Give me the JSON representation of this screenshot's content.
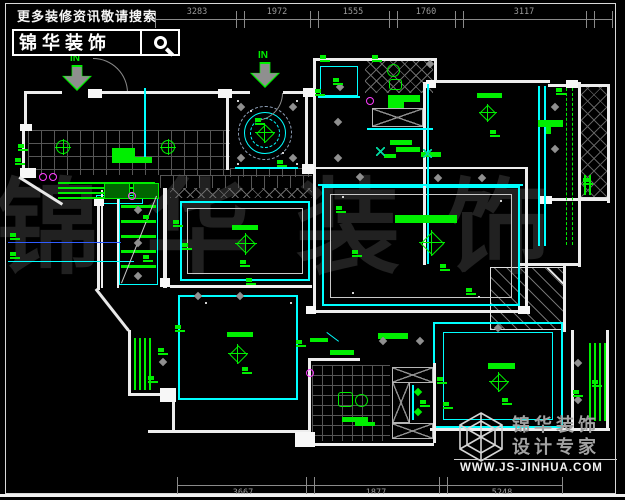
{
  "search_box": {
    "tagline": "更多装修资讯敬请搜索",
    "brand": "锦华装饰",
    "icon": "magnifier-icon"
  },
  "watermark": {
    "text": "锦华装饰"
  },
  "logo": {
    "line1": "锦华装饰",
    "line2": "设计专家",
    "website": "WWW.JS-JINHUA.COM",
    "icon": "cube-logo-icon"
  },
  "entry_markers": [
    {
      "label": "IN",
      "x": 62,
      "y": 53
    },
    {
      "label": "IN",
      "x": 250,
      "y": 50
    }
  ],
  "colors": {
    "annotation_green": "#00ef00",
    "ceiling_cyan": "#00ffff",
    "wall_white": "#ededed",
    "dim_gray": "#9a9a9a",
    "magenta": "#ff3cff",
    "leader_blue": "#2f5cff",
    "watermark_gray": "#212121"
  },
  "dimensions": {
    "top": {
      "line_y": 19,
      "x_start": 155,
      "x_end": 612,
      "boundaries": [
        155,
        240,
        314,
        393,
        459,
        590,
        612
      ],
      "labels": [
        {
          "t": "3283",
          "c": 197
        },
        {
          "t": "1972",
          "c": 277
        },
        {
          "t": "1555",
          "c": 353
        },
        {
          "t": "1760",
          "c": 426
        },
        {
          "t": "3117",
          "c": 524
        }
      ]
    },
    "bottom": {
      "line_y": 485,
      "x_start": 177,
      "x_end": 562,
      "boundaries": [
        177,
        310,
        443,
        562
      ],
      "labels": [
        {
          "t": "3667",
          "c": 243
        },
        {
          "t": "1877",
          "c": 376
        },
        {
          "t": "5248",
          "c": 502
        }
      ]
    }
  },
  "plan": {
    "walls": [
      [
        26,
        91,
        36,
        3
      ],
      [
        96,
        91,
        154,
        3
      ],
      [
        283,
        91,
        31,
        3
      ],
      [
        24,
        91,
        3,
        39
      ],
      [
        22,
        128,
        3,
        50
      ],
      [
        313,
        58,
        3,
        133
      ],
      [
        314,
        58,
        122,
        3
      ],
      [
        434,
        58,
        3,
        25
      ],
      [
        434,
        80,
        116,
        3
      ],
      [
        548,
        84,
        62,
        3
      ],
      [
        607,
        84,
        3,
        117
      ],
      [
        578,
        82,
        3,
        185
      ],
      [
        548,
        198,
        60,
        3
      ],
      [
        520,
        263,
        60,
        3
      ],
      [
        563,
        265,
        3,
        67
      ],
      [
        226,
        93,
        3,
        77
      ],
      [
        305,
        93,
        3,
        77
      ],
      [
        316,
        167,
        210,
        2
      ],
      [
        525,
        167,
        3,
        146
      ],
      [
        313,
        188,
        3,
        125
      ],
      [
        313,
        310,
        215,
        3
      ],
      [
        163,
        188,
        4,
        100
      ],
      [
        170,
        285,
        142,
        3
      ],
      [
        101,
        190,
        2,
        98
      ],
      [
        117,
        190,
        2,
        98
      ],
      [
        97,
        203,
        3,
        87
      ],
      [
        128,
        330,
        3,
        65
      ],
      [
        128,
        393,
        47,
        3
      ],
      [
        172,
        395,
        3,
        37
      ],
      [
        148,
        430,
        162,
        3
      ],
      [
        308,
        358,
        52,
        3
      ],
      [
        308,
        358,
        3,
        88
      ],
      [
        310,
        443,
        124,
        3
      ],
      [
        433,
        363,
        3,
        80
      ],
      [
        430,
        428,
        180,
        3
      ],
      [
        423,
        82,
        3,
        183
      ],
      [
        571,
        330,
        3,
        100
      ],
      [
        606,
        330,
        3,
        100
      ],
      [
        607,
        195,
        3,
        8
      ]
    ],
    "blocks": [
      [
        88,
        89,
        14,
        9
      ],
      [
        218,
        89,
        14,
        9
      ],
      [
        303,
        88,
        12,
        9
      ],
      [
        302,
        164,
        12,
        10
      ],
      [
        20,
        168,
        16,
        10
      ],
      [
        94,
        198,
        10,
        8
      ],
      [
        566,
        80,
        12,
        8
      ],
      [
        540,
        196,
        12,
        8
      ],
      [
        160,
        388,
        16,
        14
      ],
      [
        295,
        432,
        20,
        15
      ],
      [
        20,
        124,
        12,
        7
      ],
      [
        518,
        306,
        12,
        8
      ],
      [
        306,
        306,
        10,
        8
      ],
      [
        426,
        80,
        10,
        8
      ],
      [
        160,
        278,
        10,
        9
      ]
    ],
    "cyan_rects": [
      [
        320,
        66,
        38,
        30,
        1.5
      ],
      [
        322,
        186,
        198,
        120,
        2
      ],
      [
        180,
        201,
        130,
        80,
        2
      ],
      [
        178,
        295,
        120,
        105,
        2.5
      ],
      [
        433,
        322,
        130,
        106,
        2
      ],
      [
        443,
        332,
        110,
        88,
        1.5
      ],
      [
        119,
        193,
        39,
        92,
        1.5
      ],
      [
        96,
        195,
        47,
        9,
        1
      ]
    ],
    "white_rects": [
      [
        330,
        194,
        182,
        104
      ],
      [
        187,
        208,
        116,
        66
      ]
    ],
    "xboxes": [
      [
        372,
        108,
        51,
        19
      ],
      [
        392,
        367,
        41,
        16
      ],
      [
        392,
        423,
        41,
        16
      ],
      [
        392,
        382,
        18,
        41
      ]
    ],
    "hatch_cross": [
      [
        170,
        188,
        142,
        10
      ],
      [
        365,
        60,
        68,
        33
      ]
    ],
    "hatch_cross_bordered": [
      [
        580,
        86,
        28,
        112
      ]
    ],
    "hatch_diag": [
      [
        490,
        267,
        74,
        63
      ]
    ],
    "grids": [
      [
        28,
        130,
        202,
        45,
        13
      ],
      [
        160,
        175,
        152,
        13,
        13
      ],
      [
        230,
        168,
        82,
        9,
        13
      ],
      [
        312,
        365,
        78,
        76,
        10
      ]
    ],
    "cyan_lines": [
      [
        235,
        167,
        63,
        2
      ],
      [
        318,
        184,
        205,
        2
      ],
      [
        538,
        86,
        2,
        160
      ],
      [
        544,
        86,
        2,
        160
      ],
      [
        144,
        88,
        2,
        72
      ],
      [
        412,
        385,
        2,
        35
      ],
      [
        427,
        84,
        2,
        180
      ],
      [
        367,
        128,
        66,
        2
      ],
      [
        318,
        96,
        42,
        2
      ],
      [
        8,
        261,
        126,
        1
      ]
    ],
    "blue_lines": [
      [
        8,
        242,
        113,
        1
      ]
    ],
    "green_vlines": [
      [
        134,
        338,
        52
      ],
      [
        139,
        338,
        52
      ],
      [
        144,
        338,
        52
      ],
      [
        149,
        338,
        52
      ],
      [
        589,
        343,
        78
      ],
      [
        594,
        343,
        78
      ],
      [
        599,
        343,
        78
      ],
      [
        604,
        343,
        78
      ],
      [
        584,
        175,
        20
      ],
      [
        589,
        175,
        20
      ]
    ],
    "green_hlines": [
      [
        58,
        182,
        97
      ],
      [
        58,
        187,
        97
      ],
      [
        58,
        192,
        97
      ],
      [
        58,
        197,
        97
      ]
    ],
    "stair_steps": [
      [
        121,
        205,
        35
      ],
      [
        121,
        220,
        35
      ],
      [
        121,
        235,
        35
      ],
      [
        121,
        250,
        35
      ],
      [
        121,
        265,
        35
      ]
    ],
    "green_boxes": [
      [
        104,
        183,
        26,
        16
      ],
      [
        133,
        183,
        26,
        16
      ]
    ],
    "dashed_cols": [
      [
        566,
        88,
        157
      ],
      [
        572,
        88,
        157
      ]
    ],
    "bars": [
      [
        232,
        225,
        26,
        5
      ],
      [
        395,
        215,
        62,
        8
      ],
      [
        477,
        93,
        25,
        5
      ],
      [
        227,
        332,
        26,
        5
      ],
      [
        488,
        363,
        27,
        6
      ],
      [
        112,
        148,
        23,
        9
      ],
      [
        112,
        157,
        40,
        6
      ],
      [
        388,
        95,
        32,
        7
      ],
      [
        388,
        102,
        16,
        6
      ],
      [
        390,
        140,
        22,
        5
      ],
      [
        396,
        147,
        24,
        5
      ],
      [
        384,
        154,
        12,
        4
      ],
      [
        421,
        152,
        20,
        5
      ],
      [
        330,
        350,
        24,
        5
      ],
      [
        378,
        333,
        30,
        6
      ],
      [
        310,
        338,
        18,
        4
      ],
      [
        342,
        417,
        26,
        5
      ],
      [
        355,
        422,
        20,
        4
      ],
      [
        538,
        120,
        25,
        7
      ],
      [
        546,
        127,
        5,
        7
      ]
    ],
    "tags": [
      [
        18,
        144
      ],
      [
        15,
        158
      ],
      [
        10,
        233
      ],
      [
        10,
        252
      ],
      [
        173,
        220
      ],
      [
        182,
        243
      ],
      [
        240,
        260
      ],
      [
        246,
        278
      ],
      [
        255,
        118
      ],
      [
        277,
        160
      ],
      [
        333,
        78
      ],
      [
        315,
        89
      ],
      [
        352,
        250
      ],
      [
        440,
        264
      ],
      [
        336,
        206
      ],
      [
        466,
        288
      ],
      [
        490,
        130
      ],
      [
        175,
        325
      ],
      [
        158,
        348
      ],
      [
        148,
        376
      ],
      [
        242,
        367
      ],
      [
        296,
        340
      ],
      [
        437,
        377
      ],
      [
        443,
        402
      ],
      [
        420,
        400
      ],
      [
        502,
        398
      ],
      [
        592,
        380
      ],
      [
        573,
        390
      ],
      [
        320,
        55
      ],
      [
        372,
        55
      ],
      [
        143,
        215
      ],
      [
        143,
        255
      ],
      [
        583,
        178
      ],
      [
        556,
        88
      ]
    ],
    "diamonds": [
      [
        241,
        107
      ],
      [
        293,
        107
      ],
      [
        241,
        158
      ],
      [
        293,
        158
      ],
      [
        340,
        87
      ],
      [
        338,
        122
      ],
      [
        338,
        158
      ],
      [
        360,
        177
      ],
      [
        438,
        178
      ],
      [
        482,
        178
      ],
      [
        198,
        296
      ],
      [
        240,
        296
      ],
      [
        138,
        210
      ],
      [
        138,
        243
      ],
      [
        138,
        276
      ],
      [
        555,
        107
      ],
      [
        555,
        149
      ],
      [
        578,
        363
      ],
      [
        578,
        400
      ],
      [
        498,
        328
      ],
      [
        163,
        362
      ],
      [
        383,
        341
      ],
      [
        420,
        341
      ],
      [
        430,
        64
      ]
    ],
    "diamonds_green": [
      [
        418,
        392
      ],
      [
        418,
        412
      ]
    ],
    "magenta": [
      [
        43,
        177
      ],
      [
        53,
        177
      ],
      [
        310,
        373
      ],
      [
        370,
        101
      ],
      [
        132,
        196
      ]
    ],
    "green_x": [
      [
        376,
        147
      ],
      [
        423,
        149
      ]
    ],
    "lamps": [
      [
        265,
        133,
        20
      ],
      [
        246,
        244,
        22
      ],
      [
        432,
        243,
        26
      ],
      [
        488,
        113,
        18
      ],
      [
        238,
        354,
        20
      ],
      [
        499,
        382,
        20
      ]
    ],
    "circle_lamps": [
      [
        63,
        147
      ],
      [
        168,
        147
      ]
    ],
    "squares_outline": [
      [
        338,
        392,
        15,
        15
      ],
      [
        389,
        79,
        13,
        11
      ]
    ],
    "circles_outline": [
      [
        355,
        394,
        13
      ],
      [
        387,
        64,
        13
      ]
    ],
    "foyer_circles": {
      "cx": 265,
      "cy": 133,
      "rings": [
        {
          "r": 27,
          "style": "dashed",
          "color": "#8fa0b8"
        },
        {
          "r": 21,
          "style": "solid",
          "color": "#00ffff"
        },
        {
          "r": 15,
          "style": "dashed",
          "color": "#00ffff"
        }
      ]
    },
    "diagonals": [
      [
        20,
        176,
        63,
        203,
        "#e8e8e8",
        3
      ],
      [
        97,
        288,
        130,
        330,
        "#e8e8e8",
        3
      ],
      [
        121,
        283,
        156,
        196,
        "#cccccc",
        1
      ],
      [
        548,
        267,
        564,
        283,
        "#e8e8e8",
        2
      ],
      [
        327,
        332,
        339,
        341,
        "#00ffff",
        1
      ]
    ],
    "arcs": [
      [
        93,
        58,
        35,
        "tr"
      ],
      [
        255,
        93,
        28,
        "br"
      ]
    ],
    "dots": [
      [
        237,
        100
      ],
      [
        296,
        100
      ],
      [
        237,
        163
      ],
      [
        296,
        163
      ],
      [
        342,
        196
      ],
      [
        500,
        200
      ],
      [
        352,
        292
      ],
      [
        478,
        296
      ],
      [
        205,
        302
      ],
      [
        290,
        302
      ],
      [
        250,
        110
      ],
      [
        282,
        152
      ]
    ]
  }
}
